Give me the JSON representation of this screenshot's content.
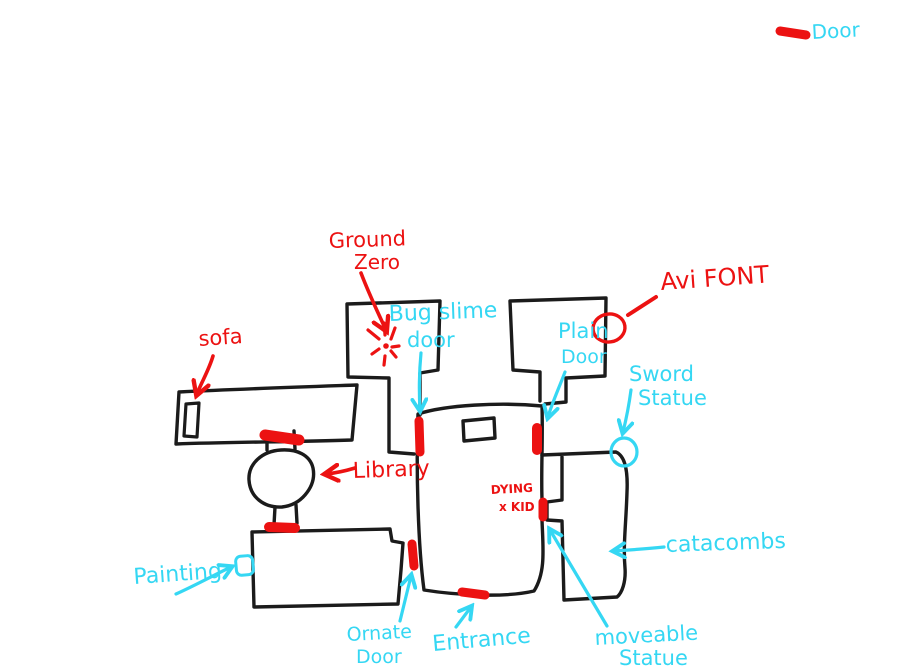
{
  "colors": {
    "red_marker": "#ec1212",
    "cyan_marker": "#35d7f3",
    "wall_ink": "#1b1b1b",
    "background": "#ffffff"
  },
  "legend": {
    "door_label": "Door"
  },
  "labels": {
    "ground_zero": {
      "line1": "Ground",
      "line2": "Zero"
    },
    "bug_slime_door": {
      "line1": "Bug slime",
      "line2": "door"
    },
    "avi_font": {
      "text": "Avi FONT"
    },
    "sofa": {
      "text": "sofa"
    },
    "plain_door": {
      "line1": "Plain",
      "line2": "Door"
    },
    "sword_statue": {
      "line1": "Sword",
      "line2": "Statue"
    },
    "library": {
      "text": "Library"
    },
    "dying_kid": {
      "line1": "DYING",
      "line2": "x KID"
    },
    "catacombs": {
      "text": "catacombs"
    },
    "painting": {
      "text": "Painting"
    },
    "ornate_door": {
      "line1": "Ornate",
      "line2": "Door"
    },
    "entrance": {
      "text": "Entrance"
    },
    "moveable_statue": {
      "line1": "moveable",
      "line2": "Statue"
    }
  }
}
